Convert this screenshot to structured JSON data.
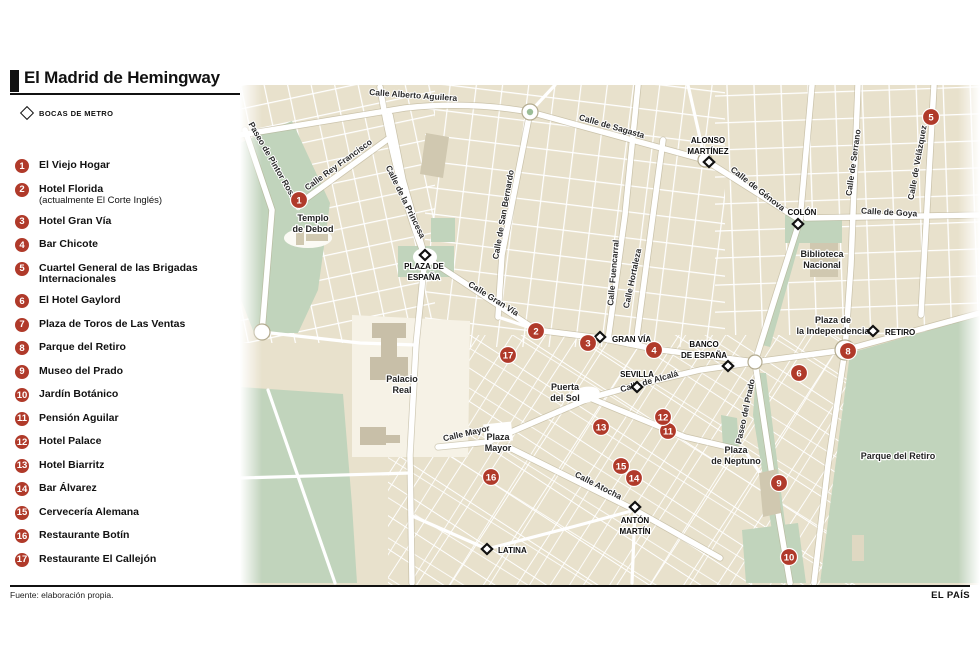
{
  "title": "El Madrid de Hemingway",
  "metro_legend": "BOCAS DE METRO",
  "footer": {
    "source": "Fuente: elaboración propia.",
    "brand": "EL PAÍS"
  },
  "colors": {
    "accent_red": "#b03a2a",
    "park_green": "#c1d4bc",
    "block_beige": "#e8e1cc",
    "building_gray": "#d0c8b0"
  },
  "legend": [
    {
      "num": "1",
      "label": "El Viejo Hogar"
    },
    {
      "num": "2",
      "label": "Hotel Florida",
      "sub": "(actualmente El Corte Inglés)"
    },
    {
      "num": "3",
      "label": "Hotel Gran Vía"
    },
    {
      "num": "4",
      "label": "Bar Chicote"
    },
    {
      "num": "5",
      "label": "Cuartel General de las Brigadas Internacionales"
    },
    {
      "num": "6",
      "label": "El Hotel Gaylord"
    },
    {
      "num": "7",
      "label": "Plaza de Toros de Las Ventas"
    },
    {
      "num": "8",
      "label": "Parque del Retiro"
    },
    {
      "num": "9",
      "label": "Museo del Prado"
    },
    {
      "num": "10",
      "label": "Jardín Botánico"
    },
    {
      "num": "11",
      "label": "Pensión Aguilar"
    },
    {
      "num": "12",
      "label": "Hotel Palace"
    },
    {
      "num": "13",
      "label": "Hotel Biarritz"
    },
    {
      "num": "14",
      "label": "Bar Álvarez"
    },
    {
      "num": "15",
      "label": "Cervecería Alemana"
    },
    {
      "num": "16",
      "label": "Restaurante Botín"
    },
    {
      "num": "17",
      "label": "Restaurante El Callejón"
    }
  ],
  "map": {
    "street_labels": [
      {
        "text": "Calle Alberto Aguilera",
        "x": 173,
        "y": 13,
        "r": 4
      },
      {
        "text": "Paseo de Pintor Rosales",
        "x": 33,
        "y": 82,
        "r": 60
      },
      {
        "text": "Calle Rey Francisco",
        "x": 100,
        "y": 82,
        "r": -36
      },
      {
        "text": "Calle de la Princesa",
        "x": 163,
        "y": 118,
        "r": 64
      },
      {
        "text": "Calle de Sagasta",
        "x": 371,
        "y": 44,
        "r": 16
      },
      {
        "text": "Calle de San Bernardo",
        "x": 266,
        "y": 130,
        "r": -80
      },
      {
        "text": "Calle Fuencarral",
        "x": 376,
        "y": 188,
        "r": -85
      },
      {
        "text": "Calle Hortaleza",
        "x": 395,
        "y": 194,
        "r": -78
      },
      {
        "text": "Calle de Génova",
        "x": 516,
        "y": 106,
        "r": 38
      },
      {
        "text": "Calle Gran Vía",
        "x": 252,
        "y": 216,
        "r": 32
      },
      {
        "text": "Calle de Alcalá",
        "x": 410,
        "y": 299,
        "r": -16
      },
      {
        "text": "Calle Mayor",
        "x": 227,
        "y": 351,
        "r": -13
      },
      {
        "text": "Calle Atocha",
        "x": 357,
        "y": 403,
        "r": 27
      },
      {
        "text": "Calle de Serrano",
        "x": 616,
        "y": 78,
        "r": -82
      },
      {
        "text": "Calle de Velázquez",
        "x": 680,
        "y": 78,
        "r": -80
      },
      {
        "text": "Calle de Goya",
        "x": 649,
        "y": 130,
        "r": 3
      },
      {
        "text": "Paseo del Prado",
        "x": 508,
        "y": 327,
        "r": -78
      }
    ],
    "place_labels": [
      {
        "lines": [
          "Templo",
          "de Debod"
        ],
        "x": 73,
        "y": 136
      },
      {
        "lines": [
          "Palacio",
          "Real"
        ],
        "x": 162,
        "y": 297
      },
      {
        "lines": [
          "Puerta",
          "del Sol"
        ],
        "x": 325,
        "y": 305
      },
      {
        "lines": [
          "Plaza",
          "Mayor"
        ],
        "x": 258,
        "y": 355
      },
      {
        "lines": [
          "Plaza de",
          "la Independencia"
        ],
        "x": 593,
        "y": 238
      },
      {
        "lines": [
          "Plaza",
          "de Neptuno"
        ],
        "x": 496,
        "y": 368
      },
      {
        "lines": [
          "Parque del Retiro"
        ],
        "x": 658,
        "y": 374
      },
      {
        "lines": [
          "Biblioteca",
          "Nacional"
        ],
        "x": 582,
        "y": 172
      }
    ],
    "metro_stations": [
      {
        "lines": [
          "PLAZA DE",
          "ESPAÑA"
        ],
        "lx": 184,
        "ly": 184,
        "anchor": "middle",
        "dx": 185,
        "dy": 170
      },
      {
        "lines": [
          "ALONSO",
          "MARTÍNEZ"
        ],
        "lx": 468,
        "ly": 58,
        "anchor": "middle",
        "dx": 469,
        "dy": 77
      },
      {
        "lines": [
          "COLÓN"
        ],
        "lx": 562,
        "ly": 130,
        "anchor": "middle",
        "dx": 558,
        "dy": 139
      },
      {
        "lines": [
          "GRAN VÍA"
        ],
        "lx": 372,
        "ly": 257,
        "anchor": "start",
        "dx": 360,
        "dy": 252
      },
      {
        "lines": [
          "SEVILLA"
        ],
        "lx": 397,
        "ly": 292,
        "anchor": "middle",
        "dx": 397,
        "dy": 302
      },
      {
        "lines": [
          "BANCO",
          "DE ESPAÑA"
        ],
        "lx": 464,
        "ly": 262,
        "anchor": "middle",
        "dx": 488,
        "dy": 281
      },
      {
        "lines": [
          "RETIRO"
        ],
        "lx": 645,
        "ly": 250,
        "anchor": "start",
        "dx": 633,
        "dy": 246
      },
      {
        "lines": [
          "ANTÓN",
          "MARTÍN"
        ],
        "lx": 395,
        "ly": 438,
        "anchor": "middle",
        "dx": 395,
        "dy": 422
      },
      {
        "lines": [
          "LATINA"
        ],
        "lx": 258,
        "ly": 468,
        "anchor": "start",
        "dx": 247,
        "dy": 464
      }
    ],
    "markers": [
      {
        "n": "1",
        "x": 59,
        "y": 115
      },
      {
        "n": "2",
        "x": 296,
        "y": 246
      },
      {
        "n": "3",
        "x": 348,
        "y": 258
      },
      {
        "n": "4",
        "x": 414,
        "y": 265
      },
      {
        "n": "5",
        "x": 691,
        "y": 32
      },
      {
        "n": "6",
        "x": 559,
        "y": 288
      },
      {
        "n": "8",
        "x": 608,
        "y": 266
      },
      {
        "n": "9",
        "x": 539,
        "y": 398
      },
      {
        "n": "10",
        "x": 549,
        "y": 472
      },
      {
        "n": "11",
        "x": 428,
        "y": 346
      },
      {
        "n": "12",
        "x": 423,
        "y": 332
      },
      {
        "n": "13",
        "x": 361,
        "y": 342
      },
      {
        "n": "14",
        "x": 394,
        "y": 393
      },
      {
        "n": "15",
        "x": 381,
        "y": 381
      },
      {
        "n": "16",
        "x": 251,
        "y": 392
      },
      {
        "n": "17",
        "x": 268,
        "y": 270
      }
    ]
  }
}
